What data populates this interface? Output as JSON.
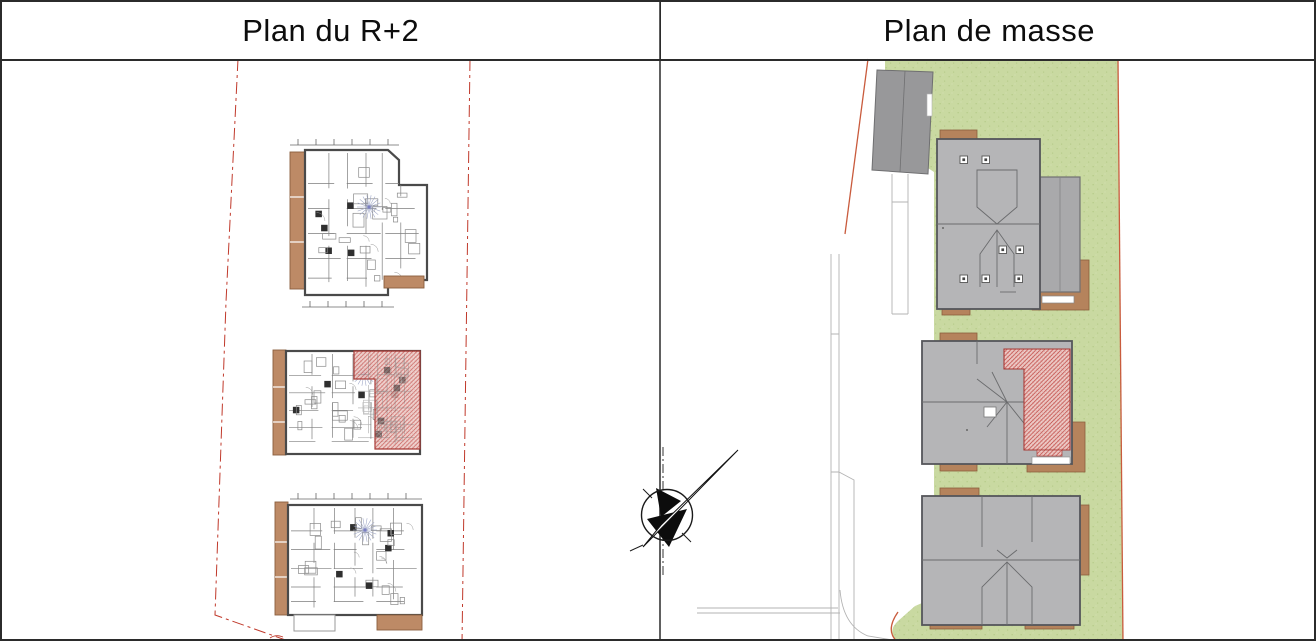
{
  "header": {
    "left_title": "Plan du R+2",
    "right_title": "Plan de masse"
  },
  "icons": {
    "north_arrow": "compass-needle-pointing-north-east"
  },
  "floor_plan_panel": {
    "buildings_count": 3,
    "highlighted_unit_building": 2,
    "highlight_style": "red diagonal hatch"
  },
  "site_plan_panel": {
    "new_buildings_count": 3,
    "existing_buildings_count": 1,
    "highlighted_roof_building": 2
  },
  "colors": {
    "lawn": "#c9d9a1",
    "lawn_speckle": "#b7cb8a",
    "lawn_speckle_light": "#d6e2b3",
    "roof": "#b5b5b7",
    "roof_stroke": "#55565a",
    "roof_annex": "#a9a9ab",
    "existing_building": "#98989a",
    "existing_building_stroke": "#6f6f71",
    "terrace": "#b5835c",
    "terrace_stroke": "#8a5f3d",
    "balcony": "#bd8a66",
    "hatch_bg": "#eccac6",
    "hatch_line": "#c4514d",
    "hatch_border": "#a83a36",
    "boundary_red": "#c0392b",
    "site_boundary": "#c95b3d",
    "wall": "#4a4a4a",
    "partition": "#7d7d7d",
    "parcel_line": "#b3b3b3",
    "fan_line": "#9aa3c4",
    "fan_dot": "#7a7ec2"
  }
}
